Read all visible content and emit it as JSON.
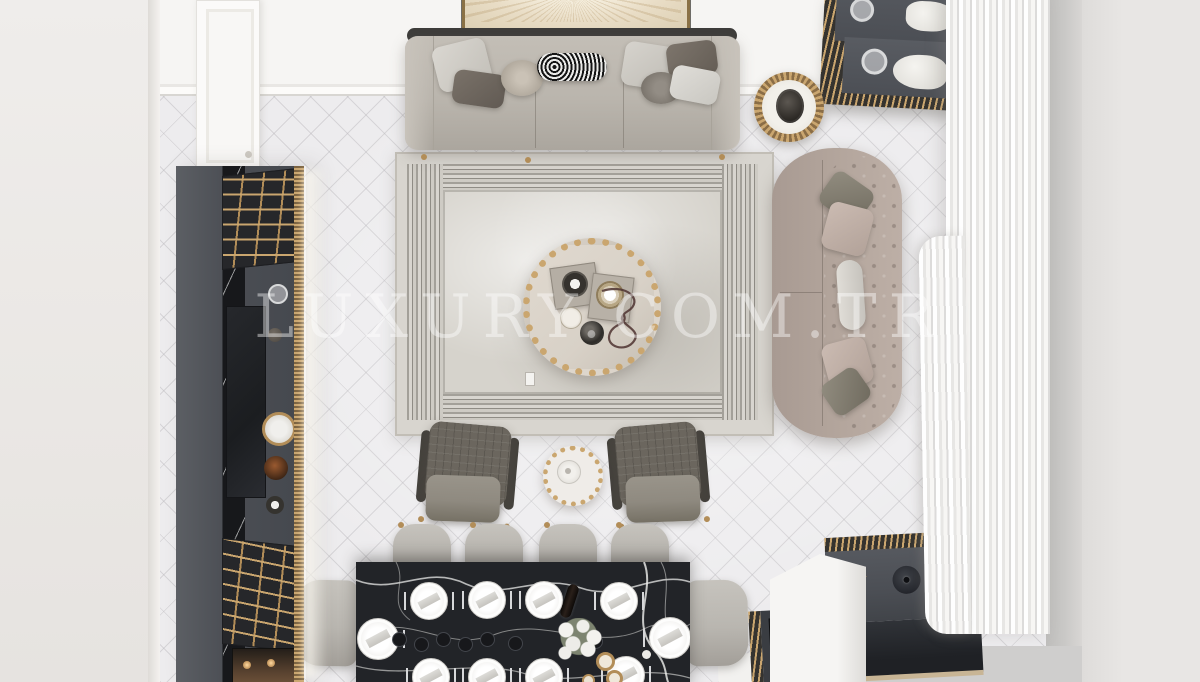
{
  "watermark": {
    "text": "LUXURY.COM.TR"
  },
  "scene": {
    "type": "interior-design-render",
    "view": "top-down",
    "room": "living-and-dining-room"
  },
  "objects": [
    "wall-art",
    "three-seat-sofa",
    "throw-pillows",
    "fringed-side-table",
    "chesterfield-sofa",
    "area-rug",
    "round-ottoman-tray",
    "armchair",
    "armchair",
    "small-side-table",
    "dining-table-black-marble",
    "dining-chairs",
    "tv-wall-unit",
    "console-top-right",
    "sideboard-bottom-right",
    "sheer-curtains",
    "entry-door",
    "herringbone-floor"
  ],
  "palette": {
    "wall": "#f6f5f3",
    "floor": "#edecee",
    "outer_left": "#eae7e4",
    "outer_right": "#e8e6e4",
    "wall_edge": "#c9c8c6",
    "anthracite": "#4b4e54",
    "anthracite_dark": "#32353a",
    "black_marble": "#222428",
    "brass": "#b28d58",
    "brass_light": "#caa66f",
    "rug": "#d8d5cf",
    "rug_stripe": "#8f8c85",
    "sofa": "#bab5ad",
    "sofa_back": "#3e3d3b",
    "chesterfield": "#b2a49b",
    "armchair": "#6b665e",
    "armchair_cushion": "#8f8a80",
    "dining_chair": "#b9b6b0",
    "ottoman": "#d8d1c7",
    "curtain": "#f4f3f1",
    "plate": "#f4f3f1"
  }
}
